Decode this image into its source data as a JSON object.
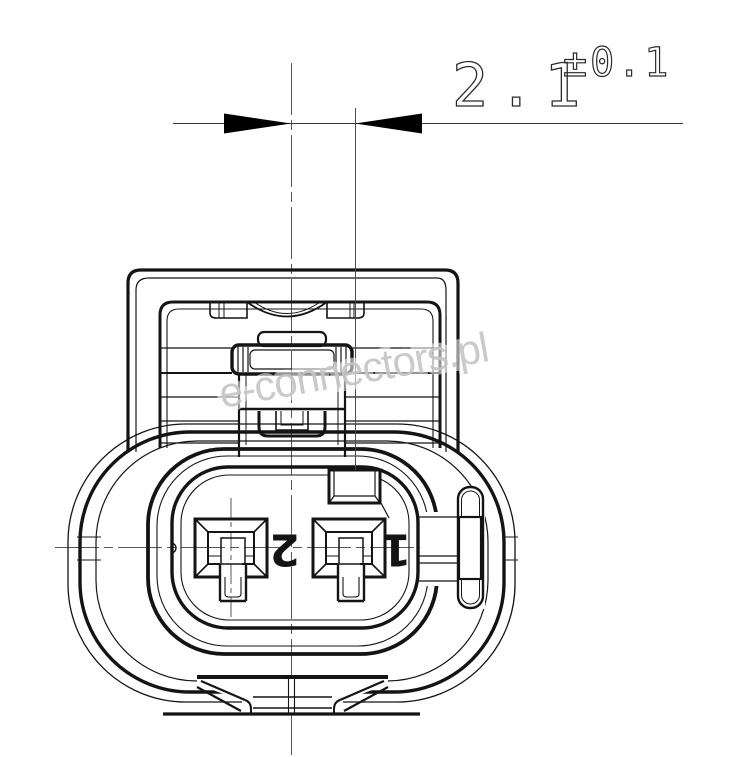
{
  "meta": {
    "type": "technical-drawing",
    "subject": "2-pin automotive connector, front view",
    "background": "#ffffff"
  },
  "dimension": {
    "value": "2.1",
    "tolerance": "±0.1"
  },
  "watermark": {
    "text": "e-connectors.pl",
    "color": "#c5c5c5"
  },
  "pins": [
    {
      "label": "2"
    },
    {
      "label": "1"
    }
  ],
  "colors": {
    "outline": "#141414",
    "thin": "#303030",
    "centerline": "#585858",
    "dimension": "#3c3c3c",
    "arrow": "#000000"
  }
}
